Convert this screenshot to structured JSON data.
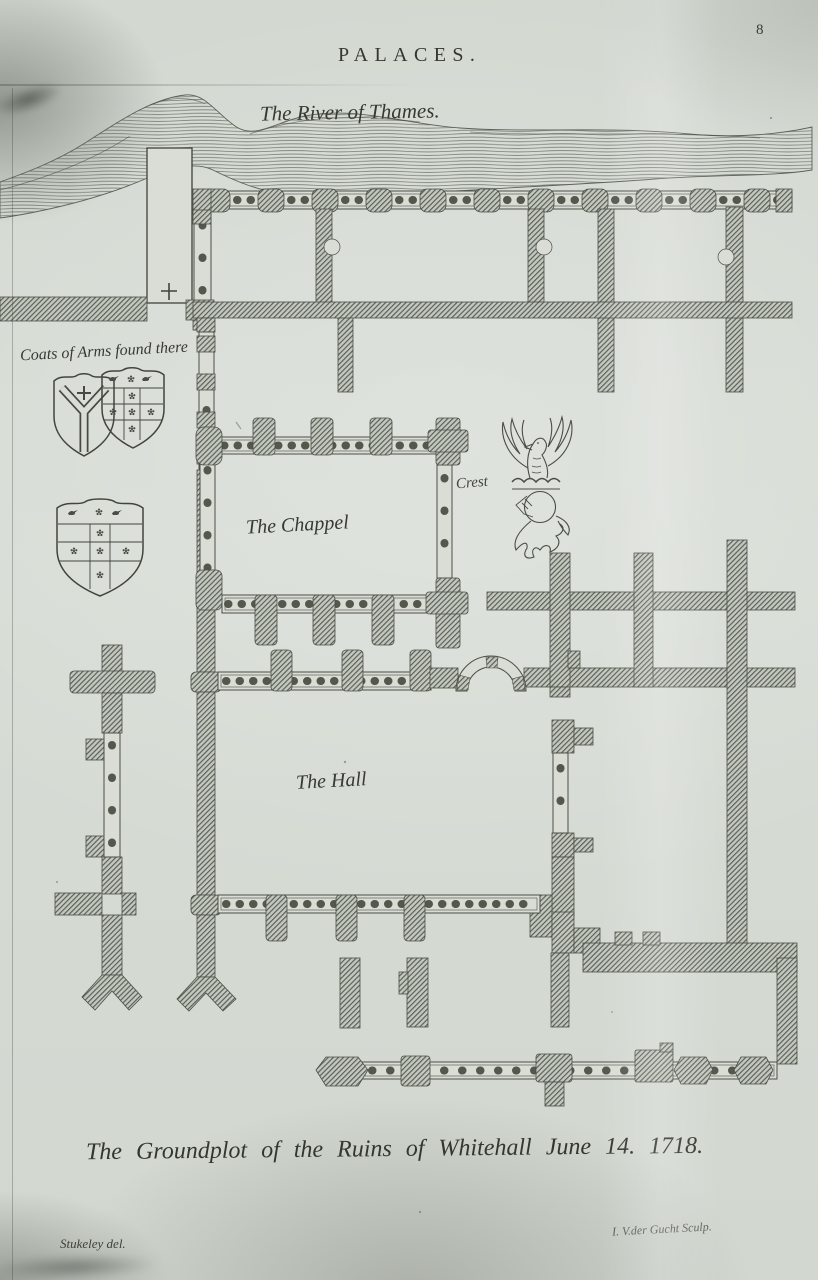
{
  "plate": {
    "page_number": "8",
    "title": "PALACES.",
    "caption": "The Groundplot of the Ruins of Whitehall June 14. 1718.",
    "credits": {
      "delineator": "Stukeley del.",
      "engraver": "I. V.der Gucht Sculp."
    }
  },
  "labels": {
    "river": "The River of Thames.",
    "coats_of_arms": "Coats of Arms found there",
    "chappel": "The Chappel",
    "crest": "Crest",
    "hall": "The Hall"
  },
  "plan": {
    "type": "engraved-groundplot",
    "rooms": [
      "The Chappel",
      "The Hall"
    ],
    "features": [
      "River of Thames",
      "stair tower with cross",
      "colonnaded galleries",
      "arched doorway",
      "heraldic shields",
      "bird crest on helm"
    ]
  },
  "colors": {
    "paper": "#d6dbd4",
    "ink": "#3a3e36",
    "wall_hatch": "#565b51"
  }
}
